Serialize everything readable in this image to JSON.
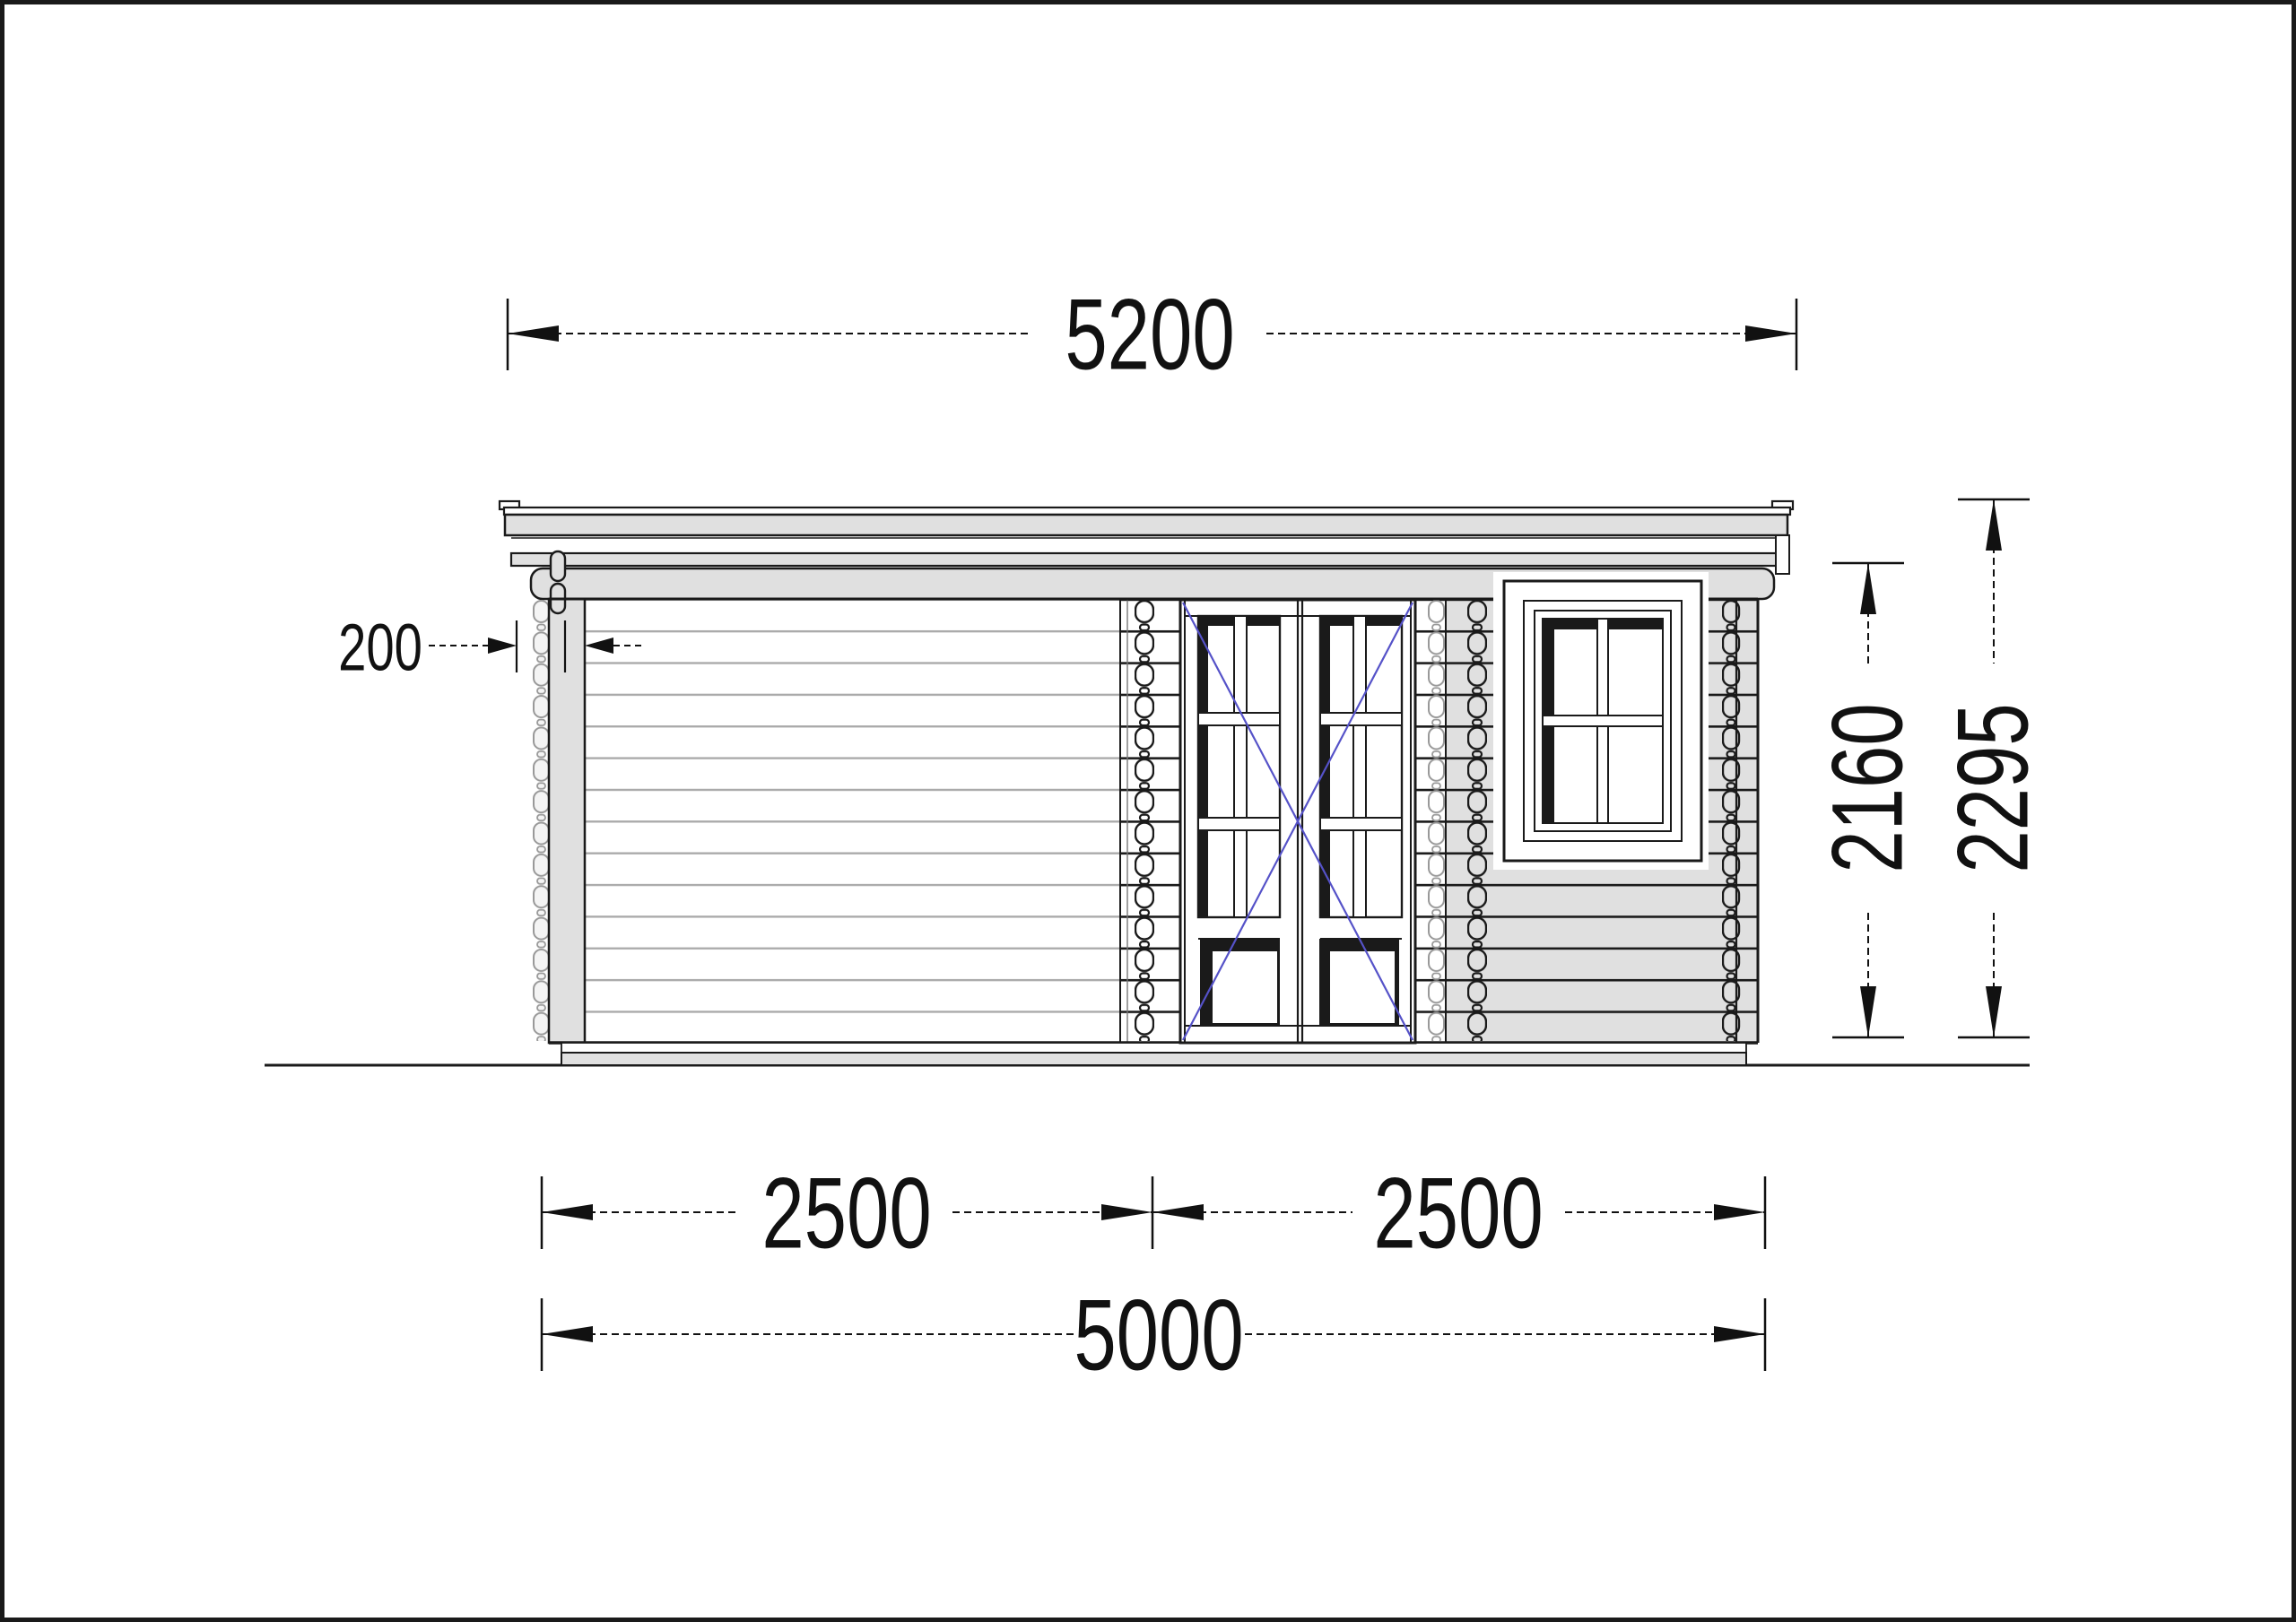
{
  "dimensions": {
    "roof_width": "5200",
    "roof_overhang": "200",
    "wall_height": "2160",
    "total_height": "2295",
    "bay_left": "2500",
    "bay_right": "2500",
    "wall_width": "5000"
  },
  "colors": {
    "line": "#1a1a1a",
    "plank_line_light": "#aaaaaa",
    "fill_gray": "#e0e0e0",
    "swing_indicator_blue": "#5552c8",
    "background": "#ffffff"
  }
}
